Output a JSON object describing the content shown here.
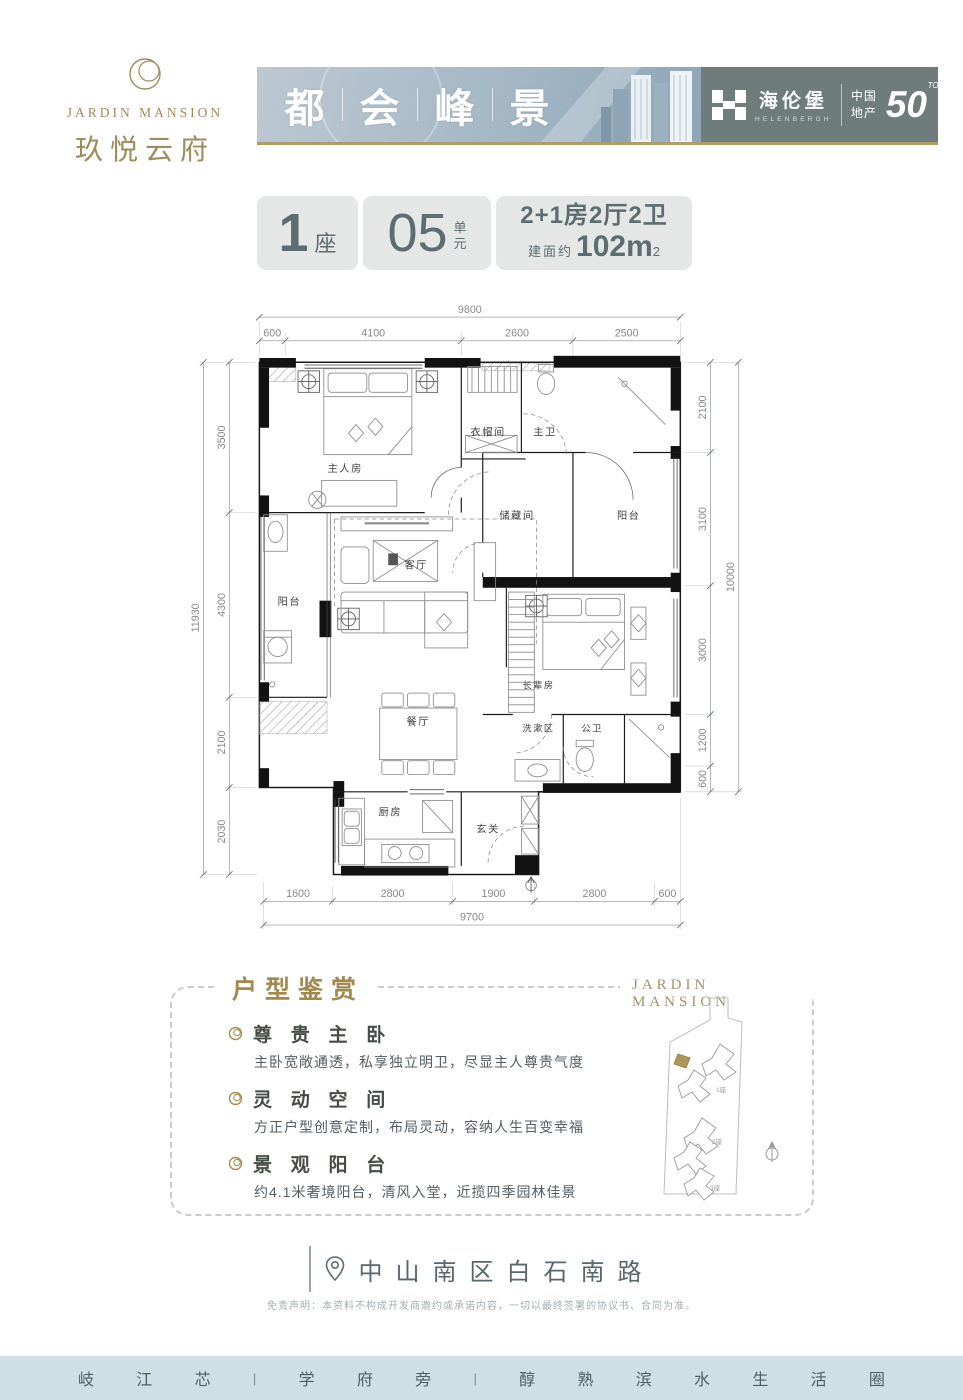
{
  "brand": {
    "logo_en": "JARDIN MANSION",
    "logo_cn": "玖悦云府",
    "banner_chars": [
      "都",
      "会",
      "峰",
      "景"
    ],
    "developer_cn": "海伦堡",
    "developer_en": "HELENBERGH",
    "badge_cn_line1": "中国",
    "badge_cn_line2": "地产",
    "badge_number": "50",
    "badge_top": "TOP"
  },
  "unit": {
    "block_number": "1",
    "block_label": "座",
    "unit_number": "05",
    "unit_label_char1": "单",
    "unit_label_char2": "元",
    "layout_text": "2+1房2厅2卫",
    "area_prefix": "建面约",
    "area_value": "102m",
    "area_exponent": "2"
  },
  "floorplan": {
    "dims": {
      "top_total": "9800",
      "top_segments": [
        "600",
        "4100",
        "2600",
        "2500"
      ],
      "left_total": "11930",
      "left_segments": [
        "3500",
        "4300",
        "2100",
        "2030"
      ],
      "right_total": "10000",
      "right_segments": [
        "2100",
        "3100",
        "3000",
        "1200",
        "600"
      ],
      "bottom_total": "9700",
      "bottom_segments": [
        "1600",
        "2800",
        "1900",
        "2800",
        "600"
      ]
    },
    "rooms": {
      "master": "主人房",
      "cloak": "衣帽间",
      "master_bath": "主卫",
      "storage": "储藏间",
      "balcony_right": "阳台",
      "balcony_left": "阳台",
      "living": "客厅",
      "dining": "餐厅",
      "elder": "长辈房",
      "wash": "洗漱区",
      "guest_bath": "公卫",
      "kitchen": "厨房",
      "foyer": "玄关"
    }
  },
  "appreciation": {
    "title": "户型鉴赏",
    "items": [
      {
        "heading": "尊 贵 主 卧",
        "desc": "主卧宽敞通透，私享独立明卫，尽显主人尊贵气度"
      },
      {
        "heading": "灵 动 空 间",
        "desc": "方正户型创意定制，布局灵动，容纳人生百变幸福"
      },
      {
        "heading": "景 观 阳 台",
        "desc": "约4.1米奢境阳台，清风入堂，近揽四季园林佳景"
      }
    ],
    "siteplan": {
      "title": "JARDIN MANSION",
      "buildings": [
        "1座",
        "2座",
        "3座"
      ]
    }
  },
  "footer": {
    "address": "中山南区白石南路",
    "disclaimer": "免责声明：本资料不构成开发商邀约或承诺内容，一切以最终签署的协议书、合同为准。",
    "tagline_tokens": [
      "岐",
      "江",
      "芯",
      "|",
      "学",
      "府",
      "旁",
      "|",
      "醇",
      "熟",
      "滨",
      "水",
      "生",
      "活",
      "圈"
    ]
  },
  "colors": {
    "gold": "#b09d63",
    "slate_text": "#5c6d71",
    "banner_blue": "#a9bbc8",
    "developer_bg": "#6e7d7c",
    "bottom_bar_bg": "#cfdfe6"
  }
}
